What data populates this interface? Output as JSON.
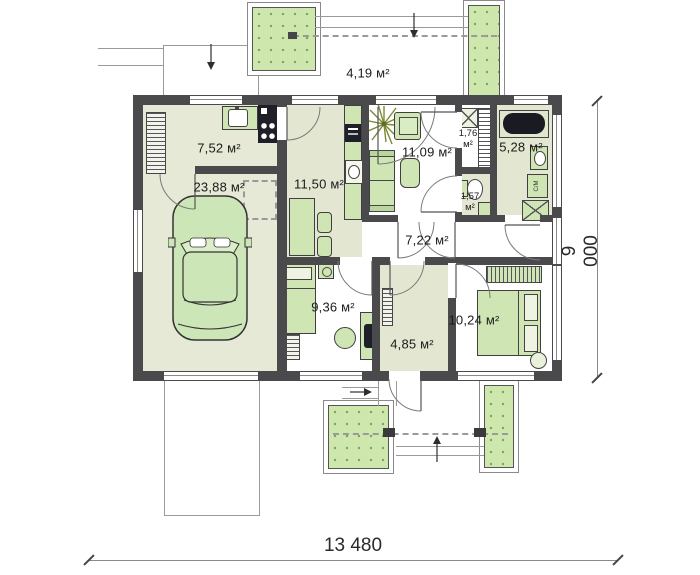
{
  "labels": {
    "exterior_area": "4,19 м²",
    "dim_width": "13 480",
    "dim_height": "9 000"
  },
  "rooms": {
    "utility": {
      "area": "7,52 м²"
    },
    "garage": {
      "area": "23,88 м²"
    },
    "kitchen": {
      "area": "11,50 м²"
    },
    "living": {
      "area": "11,09 м²"
    },
    "closet": {
      "area": "1,76 м²"
    },
    "bathroom": {
      "area": "5,28 м²"
    },
    "wc": {
      "area": "1,57 м²"
    },
    "corridor": {
      "area": "7,22 м²"
    },
    "bedroom_office": {
      "area": "9,36 м²"
    },
    "hall": {
      "area": "4,85 м²"
    },
    "bedroom": {
      "area": "10,24 м²"
    }
  },
  "appliances": {
    "washer": "С/М"
  },
  "colors": {
    "wall": "#4a4a4c",
    "floor_green": "#e6e9d6",
    "floor_white": "#ffffff",
    "furniture_green": "#cfe5b4",
    "terrace_green": "#cde7ad",
    "fixture_dark": "#1f1f2a"
  }
}
